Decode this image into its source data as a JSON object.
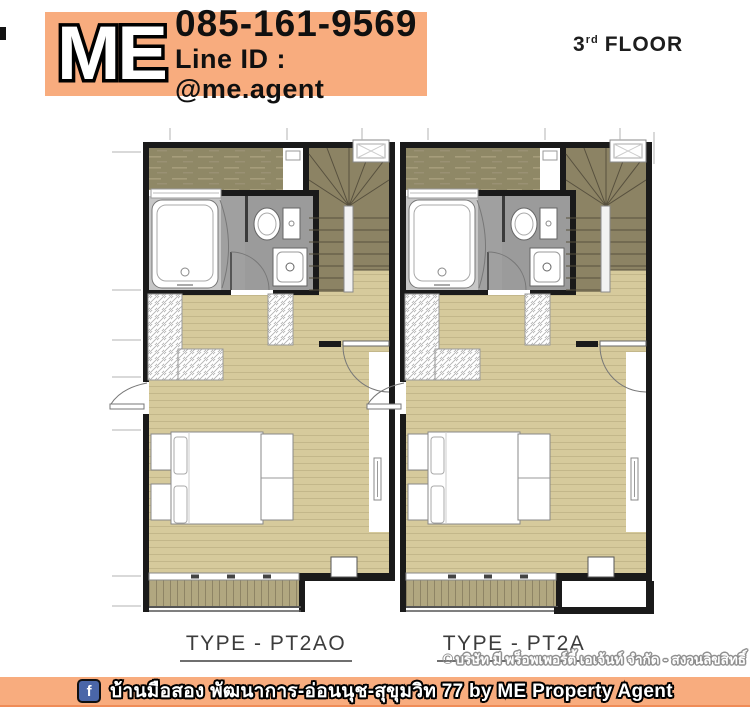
{
  "header": {
    "logo_text": "ME",
    "phone": "085-161-9569",
    "line_id": "Line ID : @me.agent",
    "floor": {
      "number": "3",
      "suffix": "rd",
      "word": "FLOOR"
    }
  },
  "plans": {
    "units": [
      {
        "label": "TYPE - PT2AO"
      },
      {
        "label": "TYPE - PT2A"
      }
    ]
  },
  "copyright": {
    "symbol": "©",
    "text": "บริษัท มี พร็อพเพอร์ตี้ เอเจ้นท์ จำกัด - สงวนลิขสิทธิ์"
  },
  "footer": {
    "facebook_letter": "f",
    "text": "บ้านมือสอง พัฒนาการ-อ่อนนุช-สุขุมวิท 77 by ME Property Agent"
  },
  "colors": {
    "accent_orange": "#f8ac7e",
    "facebook_blue": "#4a66a8",
    "floor_tan": "#d6ca9c",
    "balcony_tan": "#b1a780",
    "stair_olive": "#8c8364",
    "ledge_olive": "#8f8866",
    "bathroom_gray": "#9b9b9b",
    "wall_black": "#1a1a1a"
  }
}
